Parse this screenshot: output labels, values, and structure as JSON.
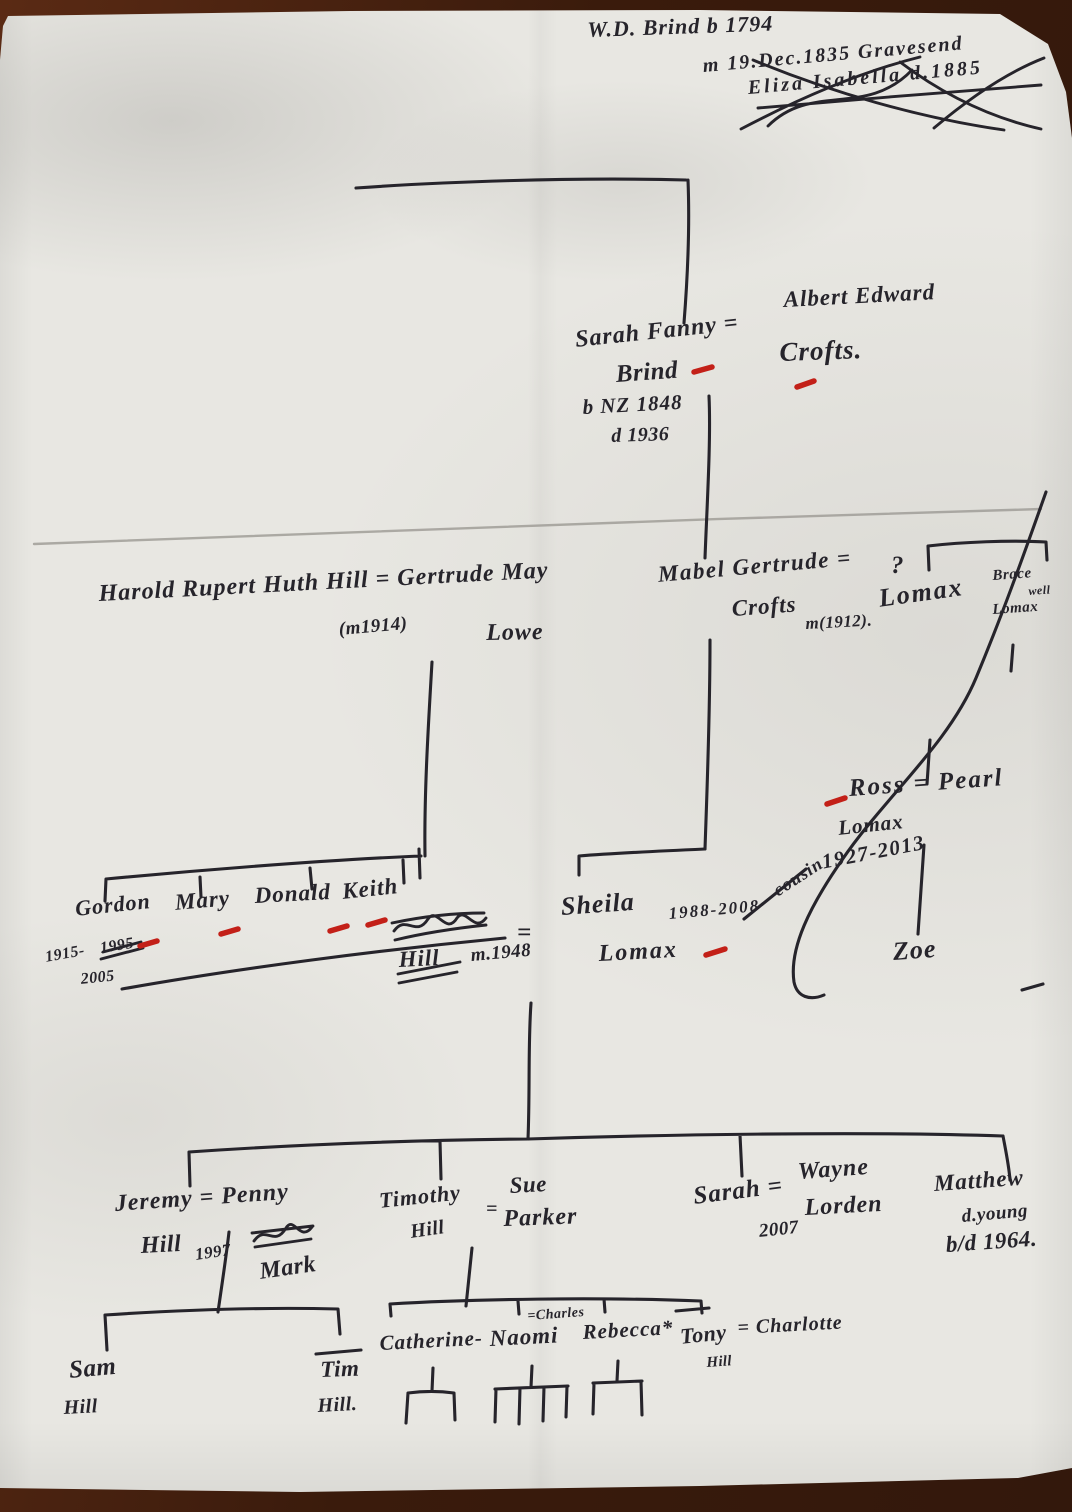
{
  "document": {
    "type": "hand-drawn family tree on paper (photo)",
    "families": "Brind / Crofts / Hill / Lomax",
    "colors": {
      "paper": "#e8e7e2",
      "table_background": "#33180c",
      "ink": "#26242b",
      "red_mark": "#c32018",
      "pencil": "#a09e98"
    }
  },
  "labels": [
    {
      "id": "wd-brind",
      "text": "W.D. Brind b 1794",
      "x": 587,
      "y": 18,
      "size": 22,
      "rot": -2,
      "ls": 1
    },
    {
      "id": "marriage-note",
      "text": "m 19.Dec.1835 Gravesend",
      "x": 702,
      "y": 56,
      "size": 20,
      "rot": -5,
      "ls": 2
    },
    {
      "id": "eliza-crossed-out",
      "text": "Eliza Isabella d.1885",
      "x": 747,
      "y": 78,
      "size": 20,
      "rot": -5,
      "ls": 3
    },
    {
      "id": "albert-edward",
      "text": "Albert Edward",
      "x": 783,
      "y": 288,
      "size": 23,
      "rot": -3,
      "ls": 1
    },
    {
      "id": "crofts",
      "text": "Crofts.",
      "x": 779,
      "y": 338,
      "size": 27,
      "rot": -2,
      "ls": 1
    },
    {
      "id": "sarah-fanny",
      "text": "Sarah Fanny =",
      "x": 574,
      "y": 328,
      "size": 24,
      "rot": -6,
      "ls": 1
    },
    {
      "id": "brind",
      "text": "Brind",
      "x": 615,
      "y": 362,
      "size": 25,
      "rot": -4,
      "ls": 0.5
    },
    {
      "id": "born-nz",
      "text": "b NZ 1848",
      "x": 582,
      "y": 396,
      "size": 21,
      "rot": -3,
      "ls": 1
    },
    {
      "id": "died-1936",
      "text": "d 1936",
      "x": 611,
      "y": 426,
      "size": 20,
      "rot": -2,
      "ls": 0.5
    },
    {
      "id": "harold-gertrude",
      "text": "Harold Rupert Huth Hill = Gertrude May",
      "x": 98,
      "y": 582,
      "size": 24,
      "rot": -3,
      "ls": 1
    },
    {
      "id": "married-1914",
      "text": "(m1914)",
      "x": 338,
      "y": 620,
      "size": 19,
      "rot": -5,
      "ls": 0.5
    },
    {
      "id": "lowe",
      "text": "Lowe",
      "x": 486,
      "y": 621,
      "size": 24,
      "rot": -1,
      "ls": 1
    },
    {
      "id": "mabel-gertrude",
      "text": "Mabel Gertrude =",
      "x": 657,
      "y": 563,
      "size": 23,
      "rot": -5,
      "ls": 1.5
    },
    {
      "id": "crofts-2",
      "text": "Crofts",
      "x": 731,
      "y": 597,
      "size": 23,
      "rot": -4,
      "ls": 1
    },
    {
      "id": "married-1912",
      "text": "m(1912).",
      "x": 805,
      "y": 615,
      "size": 17,
      "rot": -3,
      "ls": 0.5
    },
    {
      "id": "unknown-spouse",
      "text": "?",
      "x": 891,
      "y": 553,
      "size": 25,
      "rot": 0,
      "ls": 0
    },
    {
      "id": "lomax-1",
      "text": "Lomax",
      "x": 877,
      "y": 585,
      "size": 26,
      "rot": -8,
      "ls": 2
    },
    {
      "id": "bracewell-1",
      "text": "Brace",
      "x": 992,
      "y": 569,
      "size": 15,
      "rot": -4,
      "ls": 0.5
    },
    {
      "id": "bracewell-2",
      "text": "well",
      "x": 1028,
      "y": 585,
      "size": 12,
      "rot": -4,
      "ls": 0.5
    },
    {
      "id": "bracewell-lomax",
      "text": "Lomax",
      "x": 992,
      "y": 603,
      "size": 15,
      "rot": -4,
      "ls": 0.5
    },
    {
      "id": "ross-pearl",
      "text": "Ross = Pearl",
      "x": 848,
      "y": 776,
      "size": 25,
      "rot": -4,
      "ls": 2
    },
    {
      "id": "lomax-ross",
      "text": "Lomax",
      "x": 837,
      "y": 817,
      "size": 21,
      "rot": -6,
      "ls": 1
    },
    {
      "id": "ross-dates",
      "text": "1927-2013",
      "x": 820,
      "y": 851,
      "size": 21,
      "rot": -11,
      "ls": 1.5
    },
    {
      "id": "cousin-note",
      "text": "cousin",
      "x": 770,
      "y": 884,
      "size": 18,
      "rot": -33,
      "ls": 1
    },
    {
      "id": "zoe",
      "text": "Zoe",
      "x": 892,
      "y": 938,
      "size": 26,
      "rot": -4,
      "ls": 1
    },
    {
      "id": "gordon",
      "text": "Gordon",
      "x": 74,
      "y": 897,
      "size": 22,
      "rot": -6,
      "ls": 1
    },
    {
      "id": "gordon-born",
      "text": "1915-",
      "x": 44,
      "y": 950,
      "size": 16,
      "rot": -10,
      "ls": 0.5
    },
    {
      "id": "gordon-year-crossed",
      "text": "1995",
      "x": 99,
      "y": 941,
      "size": 16,
      "rot": -9,
      "ls": 0.5
    },
    {
      "id": "gordon-died",
      "text": "2005",
      "x": 80,
      "y": 972,
      "size": 16,
      "rot": -6,
      "ls": 0.5
    },
    {
      "id": "mary",
      "text": "Mary",
      "x": 174,
      "y": 891,
      "size": 23,
      "rot": -5,
      "ls": 1
    },
    {
      "id": "donald",
      "text": "Donald",
      "x": 254,
      "y": 884,
      "size": 23,
      "rot": -3,
      "ls": 1
    },
    {
      "id": "keith",
      "text": "Keith",
      "x": 341,
      "y": 880,
      "size": 23,
      "rot": -6,
      "ls": 1
    },
    {
      "id": "hill-crossed",
      "text": "Hill",
      "x": 398,
      "y": 948,
      "size": 23,
      "rot": -3,
      "ls": 1
    },
    {
      "id": "married-1948",
      "text": "m.1948",
      "x": 470,
      "y": 946,
      "size": 19,
      "rot": -5,
      "ls": 0.5
    },
    {
      "id": "equals-keith-sheila",
      "text": "=",
      "x": 517,
      "y": 920,
      "size": 25,
      "rot": 0,
      "ls": 0
    },
    {
      "id": "sheila",
      "text": "Sheila",
      "x": 560,
      "y": 893,
      "size": 26,
      "rot": -4,
      "ls": 1
    },
    {
      "id": "sheila-dates",
      "text": "1988-2008",
      "x": 668,
      "y": 905,
      "size": 17,
      "rot": -5,
      "ls": 2
    },
    {
      "id": "lomax-sheila",
      "text": "Lomax",
      "x": 598,
      "y": 942,
      "size": 24,
      "rot": -3,
      "ls": 2
    },
    {
      "id": "jeremy-penny",
      "text": "Jeremy = Penny",
      "x": 114,
      "y": 1192,
      "size": 24,
      "rot": -4,
      "ls": 1
    },
    {
      "id": "hill-jeremy",
      "text": "Hill",
      "x": 140,
      "y": 1234,
      "size": 24,
      "rot": -3,
      "ls": 0.5
    },
    {
      "id": "year-1997",
      "text": "1997",
      "x": 194,
      "y": 1246,
      "size": 17,
      "rot": -8,
      "ls": 0.5
    },
    {
      "id": "mark",
      "text": "Mark",
      "x": 258,
      "y": 1260,
      "size": 24,
      "rot": -8,
      "ls": 0.5
    },
    {
      "id": "timothy",
      "text": "Timothy",
      "x": 378,
      "y": 1189,
      "size": 22,
      "rot": -6,
      "ls": 1
    },
    {
      "id": "hill-timothy",
      "text": "Hill",
      "x": 409,
      "y": 1222,
      "size": 20,
      "rot": -8,
      "ls": 0.5
    },
    {
      "id": "equals-timothy-sue",
      "text": "=",
      "x": 486,
      "y": 1199,
      "size": 20,
      "rot": 0,
      "ls": 0
    },
    {
      "id": "sue",
      "text": "Sue",
      "x": 509,
      "y": 1174,
      "size": 23,
      "rot": -3,
      "ls": 0.5
    },
    {
      "id": "parker",
      "text": "Parker",
      "x": 503,
      "y": 1207,
      "size": 24,
      "rot": -2,
      "ls": 1
    },
    {
      "id": "sarah-2",
      "text": "Sarah =",
      "x": 692,
      "y": 1184,
      "size": 25,
      "rot": -7,
      "ls": 1
    },
    {
      "id": "year-2007",
      "text": "2007",
      "x": 758,
      "y": 1222,
      "size": 19,
      "rot": -6,
      "ls": 0.5
    },
    {
      "id": "wayne",
      "text": "Wayne",
      "x": 797,
      "y": 1160,
      "size": 24,
      "rot": -4,
      "ls": 1
    },
    {
      "id": "lorden",
      "text": "Lorden",
      "x": 804,
      "y": 1196,
      "size": 24,
      "rot": -3,
      "ls": 1
    },
    {
      "id": "matthew",
      "text": "Matthew",
      "x": 933,
      "y": 1172,
      "size": 23,
      "rot": -4,
      "ls": 1
    },
    {
      "id": "died-young",
      "text": "d.young",
      "x": 961,
      "y": 1207,
      "size": 19,
      "rot": -5,
      "ls": 0.5
    },
    {
      "id": "bd-1964",
      "text": "b/d 1964.",
      "x": 945,
      "y": 1233,
      "size": 23,
      "rot": -4,
      "ls": 0.5
    },
    {
      "id": "sam",
      "text": "Sam",
      "x": 68,
      "y": 1358,
      "size": 25,
      "rot": -5,
      "ls": 0.5
    },
    {
      "id": "hill-sam",
      "text": "Hill",
      "x": 63,
      "y": 1398,
      "size": 20,
      "rot": -3,
      "ls": 0.5
    },
    {
      "id": "tim",
      "text": "Tim",
      "x": 320,
      "y": 1358,
      "size": 23,
      "rot": -2,
      "ls": 0.5
    },
    {
      "id": "hill-tim",
      "text": "Hill.",
      "x": 317,
      "y": 1396,
      "size": 20,
      "rot": -3,
      "ls": 0.5
    },
    {
      "id": "catherine",
      "text": "Catherine-",
      "x": 379,
      "y": 1332,
      "size": 21,
      "rot": -3,
      "ls": 1
    },
    {
      "id": "naomi",
      "text": "Naomi",
      "x": 489,
      "y": 1327,
      "size": 23,
      "rot": -3,
      "ls": 1
    },
    {
      "id": "charles",
      "text": "=Charles",
      "x": 527,
      "y": 1310,
      "size": 14,
      "rot": -4,
      "ls": 0.5
    },
    {
      "id": "rebecca",
      "text": "Rebecca*",
      "x": 582,
      "y": 1321,
      "size": 21,
      "rot": -3,
      "ls": 1
    },
    {
      "id": "tony",
      "text": "Tony",
      "x": 679,
      "y": 1325,
      "size": 22,
      "rot": -6,
      "ls": 0.5
    },
    {
      "id": "hill-tony",
      "text": "Hill",
      "x": 706,
      "y": 1356,
      "size": 15,
      "rot": -4,
      "ls": 0.3
    },
    {
      "id": "charlotte",
      "text": "= Charlotte",
      "x": 737,
      "y": 1318,
      "size": 20,
      "rot": -3,
      "ls": 1
    }
  ]
}
